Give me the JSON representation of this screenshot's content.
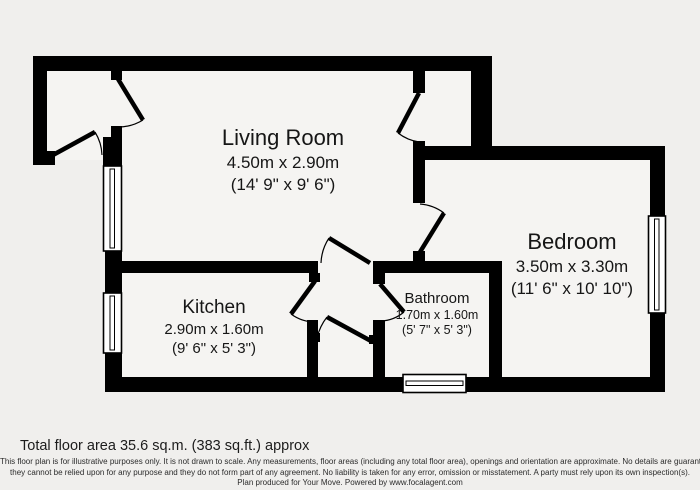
{
  "plan": {
    "rooms": [
      {
        "id": "living-room",
        "name": "Living Room",
        "dims_metric": "4.50m x 2.90m",
        "dims_imperial": "(14' 9\" x 9' 6\")"
      },
      {
        "id": "bedroom",
        "name": "Bedroom",
        "dims_metric": "3.50m x 3.30m",
        "dims_imperial": "(11' 6\" x 10' 10\")"
      },
      {
        "id": "kitchen",
        "name": "Kitchen",
        "dims_metric": "2.90m x 1.60m",
        "dims_imperial": "(9' 6\" x 5' 3\")"
      },
      {
        "id": "bathroom",
        "name": "Bathroom",
        "dims_metric": "1.70m x 1.60m",
        "dims_imperial": "(5' 7\" x 5' 3\")"
      }
    ],
    "features": [
      "front-entrance-door",
      "hall-to-living-room-door",
      "living-room-cupboard-door",
      "bedroom-door",
      "living-room-to-lobby-door",
      "kitchen-door",
      "bathroom-door",
      "lobby-cupboard-door",
      "living-room-window",
      "kitchen-window",
      "bedroom-window",
      "bathroom-window"
    ]
  },
  "footer": {
    "total_area": "Total floor area 35.6 sq.m. (383 sq.ft.) approx",
    "disclaimer_line1": "This floor plan is for illustrative purposes only. It is not drawn to scale. Any measurements, floor areas (including any total floor area), openings and orientation are approximate. No details are guaranteed,",
    "disclaimer_line2": "they cannot be relied upon for any purpose and they do not form part of any agreement. No liability is taken for any error, omission or misstatement. A party must rely upon its own inspection(s).",
    "credit": "Plan produced for Your Move. Powered by www.focalagent.com"
  },
  "colors": {
    "wall": "#000000",
    "background": "#f0efed",
    "floor": "#f5f4f2",
    "text": "#161616"
  }
}
